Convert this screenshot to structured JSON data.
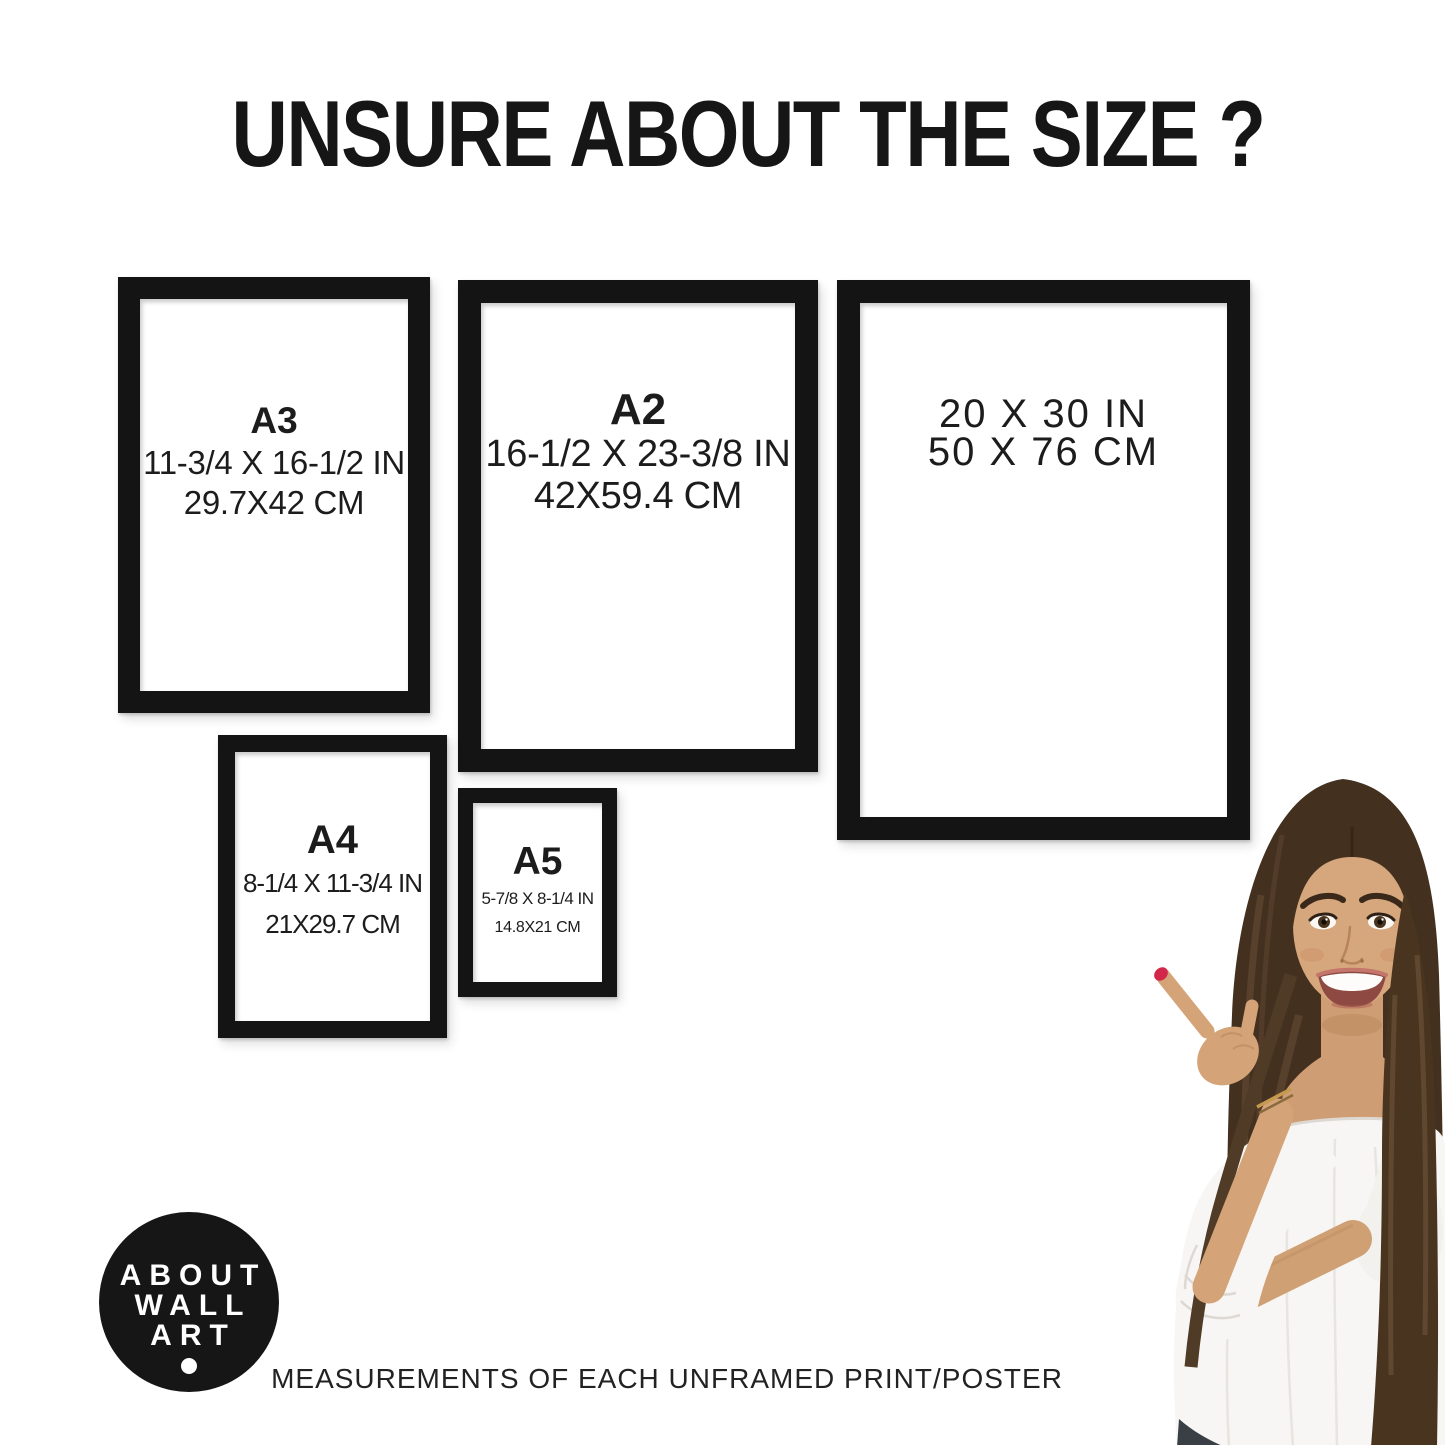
{
  "title": "UNSURE ABOUT THE SIZE ?",
  "frames": [
    {
      "name": "A3",
      "inches": "11-3/4 X 16-1/2 IN",
      "cm": "29.7X42 CM"
    },
    {
      "name": "A2",
      "inches": "16-1/2 X 23-3/8 IN",
      "cm": "42X59.4 CM"
    },
    {
      "name": "",
      "inches": "20 X 30 IN",
      "cm": "50 X 76 CM"
    },
    {
      "name": "A4",
      "inches": "8-1/4 X 11-3/4 IN",
      "cm": "21X29.7 CM"
    },
    {
      "name": "A5",
      "inches": "5-7/8 X 8-1/4 IN",
      "cm": "14.8X21 CM"
    }
  ],
  "logo": {
    "lines": [
      "ABOUT",
      "WALL",
      "ART"
    ]
  },
  "footer_caption": "MEASUREMENTS OF EACH UNFRAMED PRINT/POSTER",
  "colors": {
    "frame_border": "#141414",
    "text": "#1c1c1c",
    "logo_background": "#161616",
    "logo_text": "#ffffff",
    "nail_polish": "#d3274a",
    "hair": "#43301f",
    "skin": "#d4a378",
    "blouse": "#f7f6f4"
  }
}
